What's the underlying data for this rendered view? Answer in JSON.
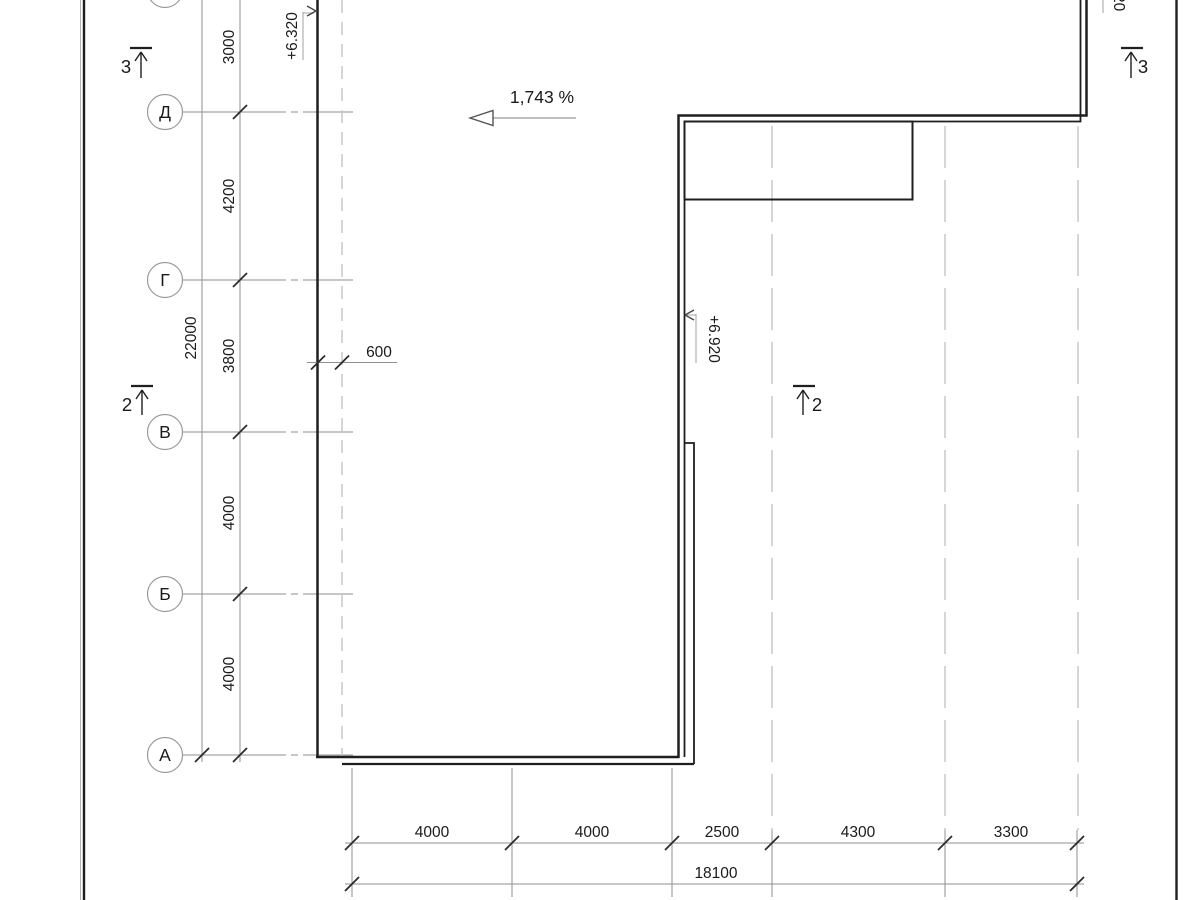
{
  "axes": {
    "labels": [
      "Д",
      "Г",
      "В",
      "Б",
      "А"
    ]
  },
  "dims_left": {
    "total": "22000",
    "segments": [
      "3000",
      "4200",
      "3800",
      "4000",
      "4000"
    ]
  },
  "dims_bottom": {
    "total": "18100",
    "segments": [
      "4000",
      "4000",
      "2500",
      "4300",
      "3300"
    ]
  },
  "dim_offset": "600",
  "slope": {
    "label": "1,743 %"
  },
  "elevations": {
    "left": "+6.320",
    "middle": "+6.920",
    "top_right_fragment": "20"
  },
  "sections": {
    "left_3": "3",
    "left_2": "2",
    "right_2": "2",
    "right_3": "3"
  },
  "colors": {
    "line_dark": "#1f1f1f",
    "line_gray": "#8f8f8f",
    "line_light": "#c9c9c9",
    "background": "#ffffff"
  }
}
